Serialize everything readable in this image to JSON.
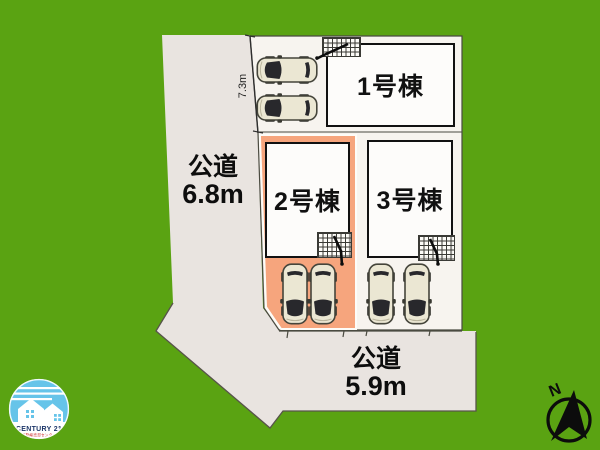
{
  "plan": {
    "buildings": [
      {
        "label": "1号棟"
      },
      {
        "label": "2号棟"
      },
      {
        "label": "3号棟"
      }
    ],
    "roads": {
      "left": {
        "name": "公道",
        "width": "6.8m"
      },
      "bottom": {
        "name": "公道",
        "width": "5.9m"
      }
    },
    "dimensions": {
      "north_boundary": "7.3m"
    }
  },
  "compass": {
    "label": "N"
  },
  "logo": {
    "brand": "CENTURY 21",
    "subtitle": "不動産売却センター"
  },
  "colors": {
    "background_green": "#5aa312",
    "road_surface": "#e9e4e0",
    "lot_surface": "#f7f4ef",
    "lot2_highlight": "#f6a57d",
    "building_fill": "#fdfcfa",
    "outline": "#111111",
    "logo_blue": "#66c4e9",
    "logo_navy": "#1c3668",
    "logo_red": "#d03030"
  },
  "icons": {
    "car": "car-top-view-icon",
    "entrance_steps": "entrance-steps-icon",
    "compass": "north-arrow-icon"
  }
}
